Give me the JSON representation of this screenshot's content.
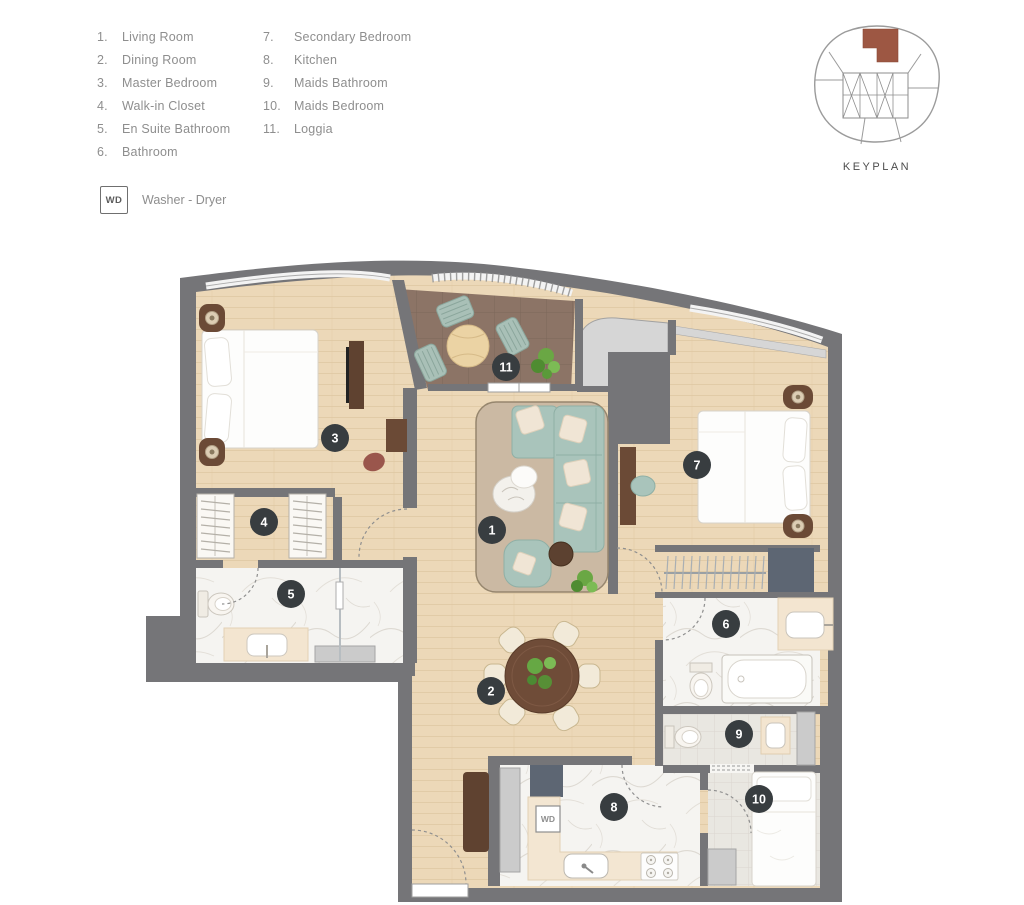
{
  "legend": {
    "col1": [
      {
        "num": "1.",
        "label": "Living Room"
      },
      {
        "num": "2.",
        "label": "Dining Room"
      },
      {
        "num": "3.",
        "label": "Master Bedroom"
      },
      {
        "num": "4.",
        "label": "Walk-in Closet"
      },
      {
        "num": "5.",
        "label": "En Suite Bathroom"
      },
      {
        "num": "6.",
        "label": "Bathroom"
      }
    ],
    "col2": [
      {
        "num": "7.",
        "label": "Secondary Bedroom"
      },
      {
        "num": "8.",
        "label": "Kitchen"
      },
      {
        "num": "9.",
        "label": "Maids Bathroom"
      },
      {
        "num": "10.",
        "label": "Maids Bedroom"
      },
      {
        "num": "11.",
        "label": "Loggia"
      }
    ],
    "washer_dryer": {
      "abbr": "WD",
      "label": "Washer - Dryer"
    }
  },
  "keyplan": {
    "label": "KEYPLAN"
  },
  "plan": {
    "wd_tag": "WD",
    "markers": [
      {
        "n": "1",
        "x": 492,
        "y": 530
      },
      {
        "n": "2",
        "x": 491,
        "y": 691
      },
      {
        "n": "3",
        "x": 335,
        "y": 438
      },
      {
        "n": "4",
        "x": 264,
        "y": 522
      },
      {
        "n": "5",
        "x": 291,
        "y": 594
      },
      {
        "n": "6",
        "x": 726,
        "y": 624
      },
      {
        "n": "7",
        "x": 697,
        "y": 465
      },
      {
        "n": "8",
        "x": 614,
        "y": 807
      },
      {
        "n": "9",
        "x": 739,
        "y": 734
      },
      {
        "n": "10",
        "x": 759,
        "y": 799
      },
      {
        "n": "11",
        "x": 506,
        "y": 367
      }
    ]
  },
  "colors": {
    "marker_bg": "#383d40",
    "marker_text": "#ffffff",
    "wall": "#757578",
    "wood": "#ecd8b8",
    "loggia_floor": "#8c7466",
    "terrace": "#d6d6d6",
    "marble": "#f5f4f1",
    "tile": "#e9e7e1",
    "sofa": "#a9c4bb",
    "rug": "#cbb9a3",
    "furniture_brown": "#6b4a36",
    "slate_box": "#5d6673",
    "keyplan_highlight": "#9d5743"
  }
}
